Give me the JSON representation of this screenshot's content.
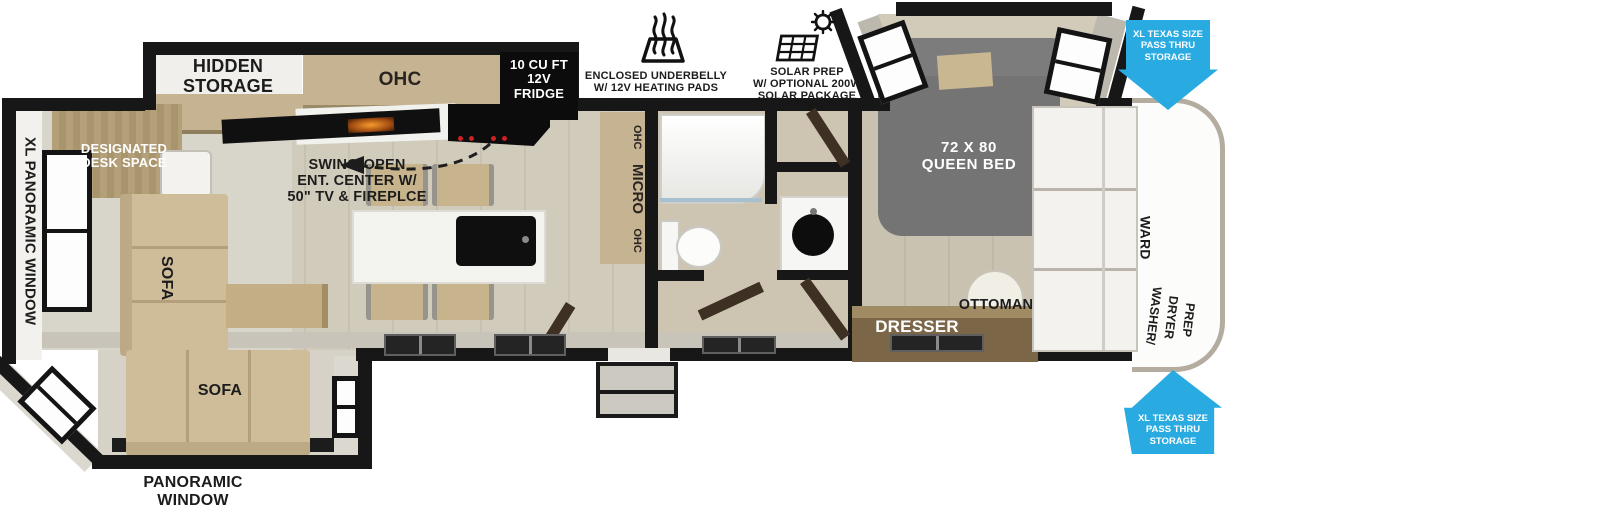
{
  "colors": {
    "accent_blue": "#29abe2",
    "wall_black": "#171717",
    "cabinet_wood": "#c5b391",
    "floor_tan": "#d1cbbc",
    "bed_gray": "#747474",
    "appliance_black": "#0c0c0c",
    "stove_knob_red": "#cc2222"
  },
  "features": {
    "underbelly": {
      "icon": "heat-waves-icon",
      "label": "ENCLOSED UNDERBELLY\nW/ 12V HEATING PADS"
    },
    "solar": {
      "icon": "solar-panel-icon",
      "label": "SOLAR PREP\nW/ OPTIONAL 200W\nSOLAR PACKAGE"
    }
  },
  "exterior": {
    "xl_panoramic_window": "XL PANORAMIC WINDOW",
    "panoramic_window": "PANORAMIC\nWINDOW",
    "pass_thru_top": "XL TEXAS SIZE\nPASS THRU\nSTORAGE",
    "pass_thru_bottom": "XL TEXAS SIZE\nPASS THRU\nSTORAGE"
  },
  "living": {
    "hidden_storage": "HIDDEN\nSTORAGE",
    "swing_open": "SWING-OPEN\nENT. CENTER W/\n50\" TV & FIREPLCE",
    "desk": "DESIGNATED\nDESK SPACE",
    "sofa_side": "SOFA",
    "sofa_rear": "SOFA"
  },
  "kitchen": {
    "ohc": "OHC",
    "fridge": "10 CU FT\n12V\nFRIDGE",
    "pantry": [
      "OHC",
      "MICRO",
      "OHC"
    ]
  },
  "bedroom": {
    "bed": "72 X 80\nQUEEN BED",
    "dresser": "DRESSER",
    "ottoman": "OTTOMAN",
    "wardrobe": "WARD",
    "washer_dryer": "WASHER/\nDRYER\nPREP"
  }
}
